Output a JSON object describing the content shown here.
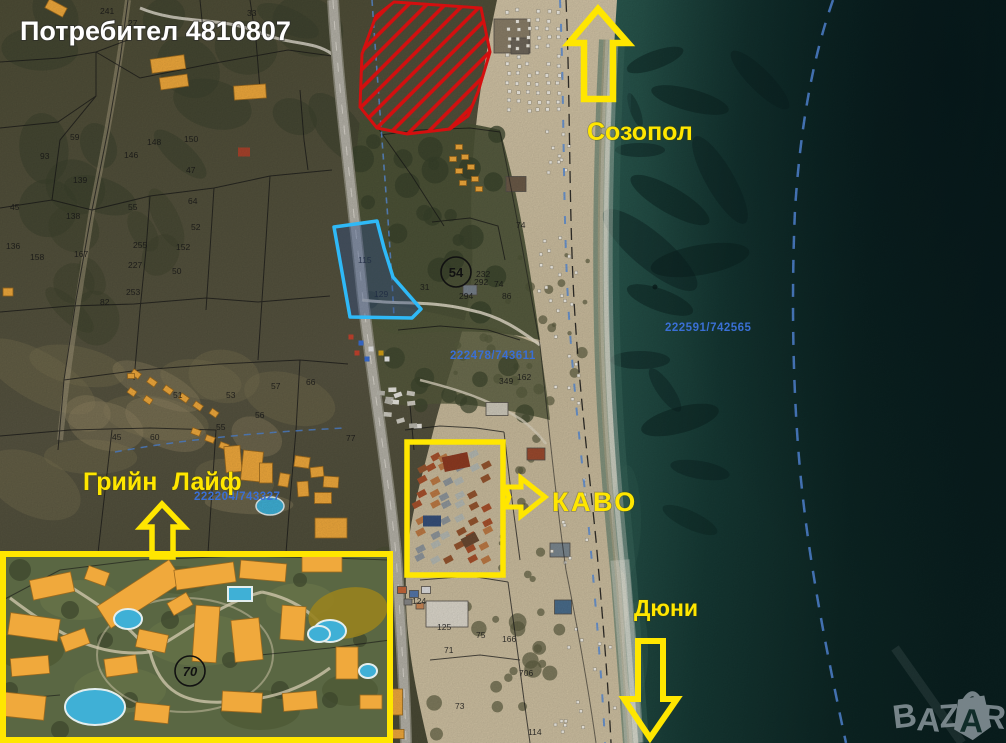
{
  "page": {
    "title_overlay": "Потребител 4810807",
    "watermark": "BAZAR"
  },
  "labels": {
    "sozopol": "Созопол",
    "green_life": "Грийн Лайф",
    "kavo": "КАВО",
    "dyuni": "Дюни"
  },
  "coordinates": [
    "222591/742565",
    "222478/743611",
    "222204/743327"
  ],
  "markers": {
    "site_circle": "54",
    "resort_circle": "70"
  },
  "parcel_numbers": [
    {
      "t": "241",
      "x": 100,
      "y": 14
    },
    {
      "t": "33",
      "x": 247,
      "y": 16
    },
    {
      "t": "27",
      "x": 128,
      "y": 26
    },
    {
      "t": "59",
      "x": 70,
      "y": 140
    },
    {
      "t": "148",
      "x": 147,
      "y": 145
    },
    {
      "t": "150",
      "x": 184,
      "y": 142
    },
    {
      "t": "146",
      "x": 124,
      "y": 158
    },
    {
      "t": "93",
      "x": 40,
      "y": 159
    },
    {
      "t": "47",
      "x": 186,
      "y": 173
    },
    {
      "t": "139",
      "x": 73,
      "y": 183
    },
    {
      "t": "64",
      "x": 188,
      "y": 204
    },
    {
      "t": "55",
      "x": 128,
      "y": 210
    },
    {
      "t": "138",
      "x": 66,
      "y": 219
    },
    {
      "t": "52",
      "x": 191,
      "y": 230
    },
    {
      "t": "136",
      "x": 6,
      "y": 249
    },
    {
      "t": "255",
      "x": 133,
      "y": 248
    },
    {
      "t": "152",
      "x": 176,
      "y": 250
    },
    {
      "t": "167",
      "x": 74,
      "y": 257
    },
    {
      "t": "158",
      "x": 30,
      "y": 260
    },
    {
      "t": "227",
      "x": 128,
      "y": 268
    },
    {
      "t": "50",
      "x": 172,
      "y": 274
    },
    {
      "t": "253",
      "x": 126,
      "y": 295
    },
    {
      "t": "82",
      "x": 100,
      "y": 305
    },
    {
      "t": "45",
      "x": 10,
      "y": 210
    },
    {
      "t": "51",
      "x": 173,
      "y": 398
    },
    {
      "t": "53",
      "x": 226,
      "y": 398
    },
    {
      "t": "57",
      "x": 271,
      "y": 389
    },
    {
      "t": "66",
      "x": 306,
      "y": 385
    },
    {
      "t": "56",
      "x": 255,
      "y": 418
    },
    {
      "t": "55",
      "x": 216,
      "y": 430
    },
    {
      "t": "60",
      "x": 150,
      "y": 440
    },
    {
      "t": "45",
      "x": 112,
      "y": 440
    },
    {
      "t": "77",
      "x": 346,
      "y": 441
    },
    {
      "t": "115",
      "x": 358,
      "y": 263
    },
    {
      "t": "129",
      "x": 374,
      "y": 297
    },
    {
      "t": "31",
      "x": 420,
      "y": 290
    },
    {
      "t": "232",
      "x": 476,
      "y": 277
    },
    {
      "t": "292",
      "x": 474,
      "y": 285
    },
    {
      "t": "294",
      "x": 459,
      "y": 299
    },
    {
      "t": "74",
      "x": 494,
      "y": 287
    },
    {
      "t": "86",
      "x": 502,
      "y": 299
    },
    {
      "t": "74",
      "x": 516,
      "y": 228
    },
    {
      "t": "162",
      "x": 517,
      "y": 380
    },
    {
      "t": "349",
      "x": 499,
      "y": 384
    },
    {
      "t": "75",
      "x": 476,
      "y": 638
    },
    {
      "t": "71",
      "x": 444,
      "y": 653
    },
    {
      "t": "73",
      "x": 455,
      "y": 709
    },
    {
      "t": "706",
      "x": 519,
      "y": 676
    },
    {
      "t": "114",
      "x": 528,
      "y": 735
    },
    {
      "t": "166",
      "x": 502,
      "y": 642
    },
    {
      "t": "125",
      "x": 437,
      "y": 630
    },
    {
      "t": "124",
      "x": 412,
      "y": 604
    },
    {
      "t": "224",
      "x": 364,
      "y": 570
    }
  ],
  "colors": {
    "annotation_yellow": "#ffe600",
    "restricted_red": "#d40f0f",
    "highlight_cyan": "#2fb9f7",
    "coordinate_blue": "#3a6fd4",
    "overlay_white": "#ffffff",
    "watermark_gray": "#8a969c"
  }
}
